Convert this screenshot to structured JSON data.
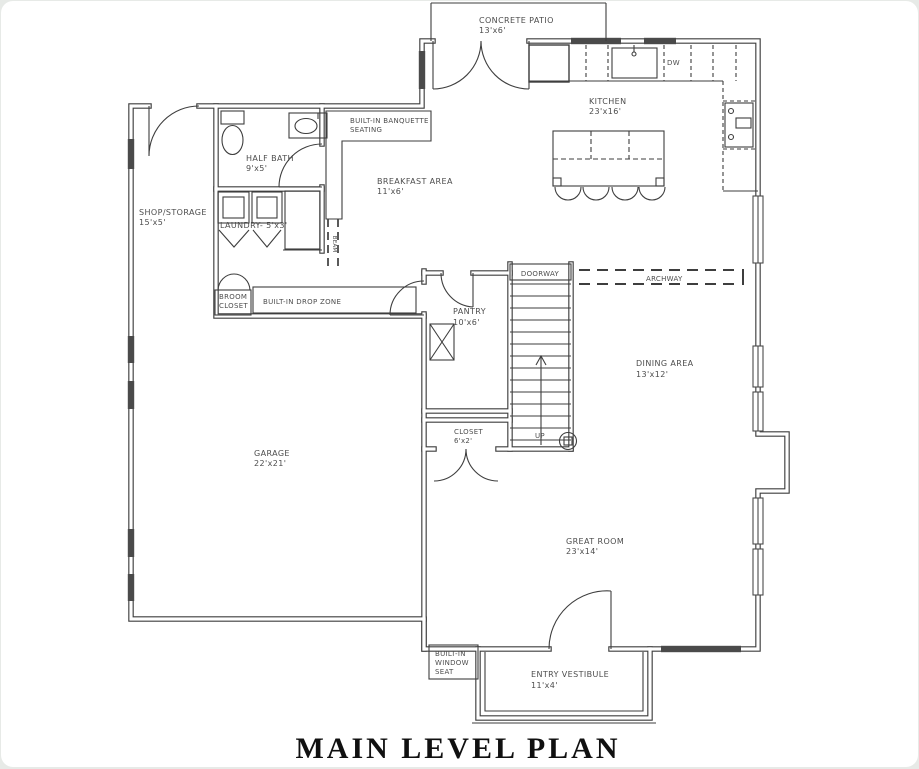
{
  "title": "MAIN LEVEL PLAN",
  "rooms": {
    "patio": {
      "name": "CONCRETE PATIO",
      "dims": "13'x6'"
    },
    "kitchen": {
      "name": "KITCHEN",
      "dims": "23'x16'"
    },
    "breakfast": {
      "name": "BREAKFAST AREA",
      "dims": "11'x6'"
    },
    "half_bath": {
      "name": "HALF BATH",
      "dims": "9'x5'"
    },
    "shop": {
      "name": "SHOP/STORAGE",
      "dims": "15'x5'"
    },
    "laundry": {
      "name": "LAUNDRY- 5'x3'"
    },
    "garage": {
      "name": "GARAGE",
      "dims": "22'x21'"
    },
    "pantry": {
      "name": "PANTRY",
      "dims": "10'x6'"
    },
    "dining": {
      "name": "DINING AREA",
      "dims": "13'x12'"
    },
    "great_room": {
      "name": "GREAT ROOM",
      "dims": "23'x14'"
    },
    "closet": {
      "name": "CLOSET",
      "dims": "6'x2'"
    },
    "vestibule": {
      "name": "ENTRY VESTIBULE",
      "dims": "11'x4'"
    }
  },
  "features": {
    "banquette_line1": "BUILT-IN BANQUETTE",
    "banquette_line2": "SEATING",
    "broom_line1": "BROOM",
    "broom_line2": "CLOSET",
    "drop_zone": "BUILT-IN DROP ZONE",
    "window_seat_line1": "BUILT-IN",
    "window_seat_line2": "WINDOW",
    "window_seat_line3": "SEAT",
    "doorway": "DOORWAY",
    "archway": "ARCHWAY",
    "dishwasher": "DW",
    "stairs_up": "UP",
    "beam": "BEAM"
  },
  "colors": {
    "line": "#3e3e3e",
    "label": "#4d4d4d",
    "title": "#101010",
    "frame": "#e7eae7"
  }
}
